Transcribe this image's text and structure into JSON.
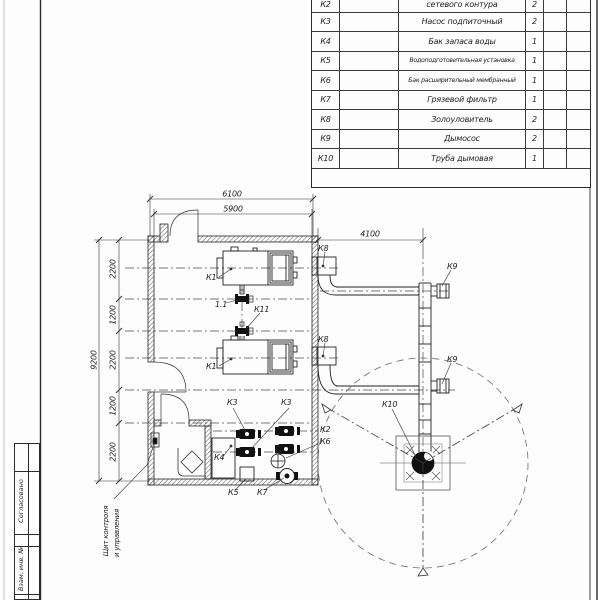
{
  "spec_table": {
    "rows": [
      {
        "pos": "К2",
        "name": "сетевого контура",
        "qty": "2"
      },
      {
        "pos": "К3",
        "name": "Насос подпиточный",
        "qty": "2"
      },
      {
        "pos": "К4",
        "name": "Бак запаса воды",
        "qty": "1"
      },
      {
        "pos": "К5",
        "name": "Водоподготовительная установка",
        "qty": "1"
      },
      {
        "pos": "К6",
        "name": "Бак расширительный мембранный",
        "qty": "1"
      },
      {
        "pos": "К7",
        "name": "Грязевой фильтр",
        "qty": "1"
      },
      {
        "pos": "К8",
        "name": "Золоуловитель",
        "qty": "2"
      },
      {
        "pos": "К9",
        "name": "Дымосос",
        "qty": "2"
      },
      {
        "pos": "К10",
        "name": "Труба дымовая",
        "qty": "1"
      }
    ]
  },
  "plan": {
    "dims": {
      "top_overall": "6100",
      "top_inner": "5900",
      "left_overall": "9200",
      "chain": [
        "2200",
        "1200",
        "2200",
        "1200",
        "2200"
      ],
      "right": "4100"
    },
    "labels": {
      "k1a": "К1",
      "k1b": "К1",
      "v11": "1.1",
      "k11": "К11",
      "k8a": "К8",
      "k8b": "К8",
      "k9a": "К9",
      "k9b": "К9",
      "k10": "К10",
      "k3a": "К3",
      "k3b": "К3",
      "k2": "К2",
      "k6": "К6",
      "k4": "К4",
      "k5": "К5",
      "k7": "К7"
    },
    "callout": {
      "line1": "Щит контроля",
      "line2": "и управления"
    }
  },
  "title_strip": {
    "agreed": "Согласовано",
    "inv": "Взам. инв. №"
  },
  "colors": {
    "line": "#2b2b2b",
    "axis": "#444444",
    "hatch": "#666666"
  }
}
